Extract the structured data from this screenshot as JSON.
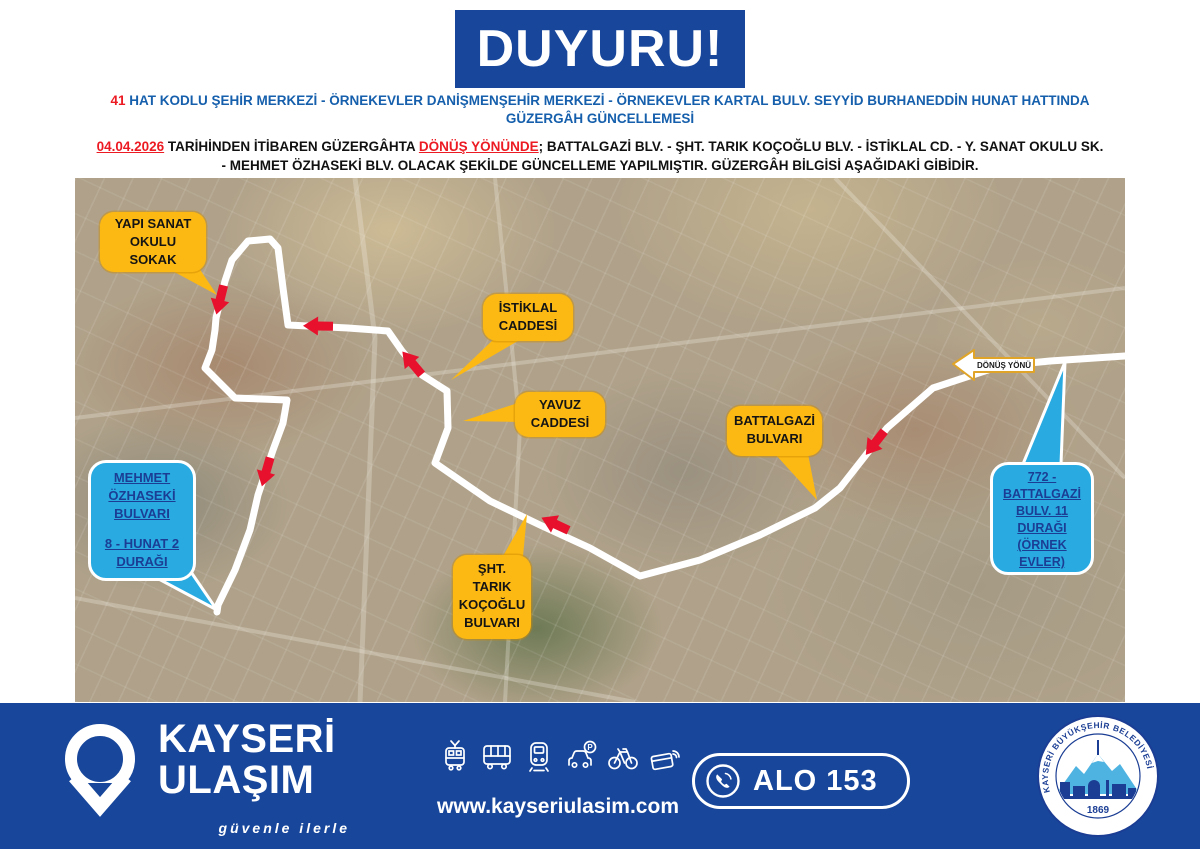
{
  "banner": {
    "title": "DUYURU!"
  },
  "headline": {
    "route_number": "41",
    "line1": " HAT KODLU ŞEHİR MERKEZİ - ÖRNEKEVLER DANİŞMENŞEHİR MERKEZİ - ÖRNEKEVLER KARTAL BULV. SEYYİD BURHANEDDİN HUNAT HATTINDA",
    "line2": "GÜZERGÂH GÜNCELLEMESİ"
  },
  "notice": {
    "date": "04.04.2026",
    "mid": " TARİHİNDEN İTİBAREN GÜZERGÂHTA ",
    "direction": "DÖNÜŞ YÖNÜNDE",
    "rest": "; BATTALGAZİ BLV. - ŞHT. TARIK KOÇOĞLU BLV. - İSTİKLAL CD. - Y. SANAT OKULU SK.",
    "line2": "- MEHMET ÖZHASEKİ BLV.  OLACAK ŞEKİLDE GÜNCELLEME YAPILMIŞTIR. GÜZERGÂH BİLGİSİ AŞAĞIDAKİ GİBİDİR."
  },
  "map": {
    "direction_label": "DÖNÜŞ YÖNÜ",
    "callouts": {
      "yapi_sanat": {
        "lines": [
          "YAPI SANAT",
          "OKULU",
          "SOKAK"
        ]
      },
      "istiklal": {
        "lines": [
          "İSTİKLAL",
          "CADDESİ"
        ]
      },
      "yavuz": {
        "lines": [
          "YAVUZ",
          "CADDESİ"
        ]
      },
      "battalgazi": {
        "lines": [
          "BATTALGAZİ",
          "BULVARI"
        ]
      },
      "sht_tarik": {
        "lines": [
          "ŞHT.",
          "TARIK",
          "KOÇOĞLU",
          "BULVARI"
        ]
      },
      "mehmet_ozhaseki": {
        "street": [
          "MEHMET",
          "ÖZHASEKİ",
          "BULVARI"
        ],
        "stop": [
          "8 - HUNAT 2",
          "DURAĞI"
        ]
      },
      "battalgazi_11": {
        "lines": [
          "772 -",
          "BATTALGAZİ",
          "BULV. 11",
          "DURAĞI",
          "(ÖRNEK",
          "EVLER)"
        ]
      }
    }
  },
  "footer": {
    "brand_line1": "KAYSERİ",
    "brand_line2": "ULAŞIM",
    "tagline": "güvenle ilerle",
    "website": "www.kayseriulasim.com",
    "phone_label": "ALO 153",
    "icons": [
      "tram",
      "bus",
      "metro",
      "car-parking",
      "bicycle",
      "contactless-card"
    ],
    "badge": {
      "text": "KAYSERİ BÜYÜKŞEHİR BELEDİYESİ",
      "year": "1869"
    }
  },
  "colors": {
    "navy": "#17469B",
    "heading_blue": "#155FAC",
    "alert_red": "#EC1B23",
    "callout_yellow": "#FDB913",
    "callout_blue": "#29ABE2",
    "callout_blue_text": "#1B3E94",
    "route": "#FFFFFF"
  }
}
